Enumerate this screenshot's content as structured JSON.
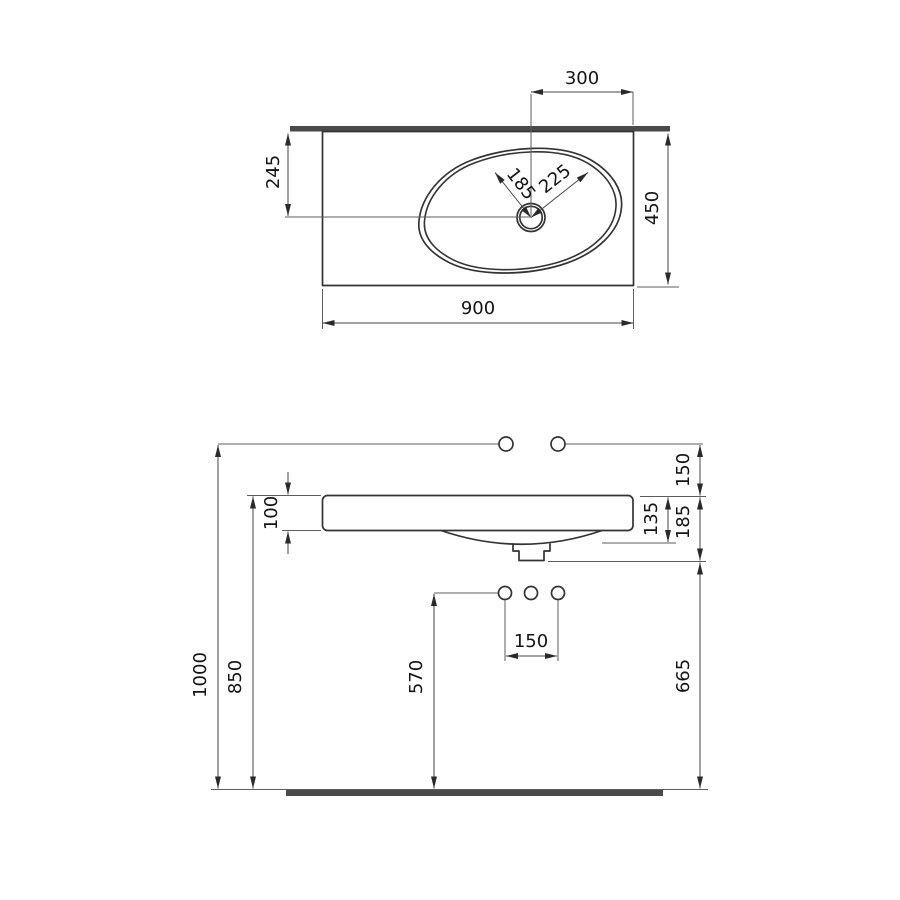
{
  "drawing": {
    "colors": {
      "line": "#333333",
      "dim_line": "#454545",
      "bar": "#4a4a4a",
      "background": "#ffffff"
    },
    "top_view": {
      "width": "900",
      "depth": "450",
      "drain_offset_from_right": "300",
      "drain_offset_from_back": "245",
      "bowl_radius_left": "185",
      "bowl_radius_right": "225"
    },
    "front_view": {
      "supply_line_height": "1000",
      "rim_height": "850",
      "trap_outlet_height": "570",
      "supply_hole_spacing": "150",
      "right_side_lower_total": "665",
      "supply_above_rim": "150",
      "apron_thickness": "100",
      "bowl_projection": "135",
      "overall_projection": "185"
    }
  }
}
